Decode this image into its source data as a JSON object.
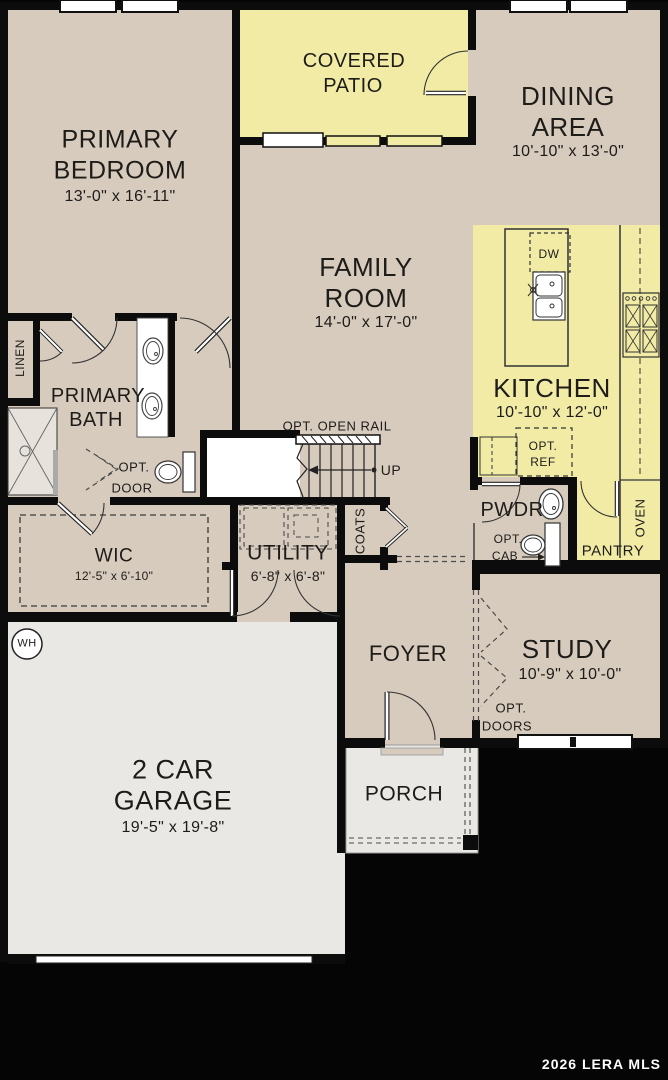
{
  "watermark": "2026 LERA MLS",
  "colors": {
    "floor_tan": "#d7cbbd",
    "floor_yellow": "#f1eba6",
    "floor_gray": "#e9e8e4",
    "wall": "#0c0c0c",
    "fixture_white": "#ffffff",
    "text": "#1e1c19"
  },
  "rooms": {
    "primary_bedroom": {
      "line1": "PRIMARY",
      "line2": "BEDROOM",
      "dims": "13'-0\" x 16'-11\""
    },
    "covered_patio": {
      "line1": "COVERED",
      "line2": "PATIO"
    },
    "dining_area": {
      "line1": "DINING",
      "line2": "AREA",
      "dims": "10'-10\" x 13'-0\""
    },
    "family_room": {
      "line1": "FAMILY",
      "line2": "ROOM",
      "dims": "14'-0\" x 17'-0\""
    },
    "kitchen": {
      "name": "KITCHEN",
      "dims": "10'-10\" x 12'-0\""
    },
    "primary_bath": {
      "line1": "PRIMARY",
      "line2": "BATH"
    },
    "linen": {
      "name": "LINEN"
    },
    "wic": {
      "name": "WIC",
      "dims": "12'-5\" x 6'-10\""
    },
    "utility": {
      "name": "UTILITY",
      "dims": "6'-8\" x 6'-8\""
    },
    "coats": {
      "name": "COATS"
    },
    "pwdr": {
      "name": "PWDR"
    },
    "pantry": {
      "name": "PANTRY"
    },
    "oven": {
      "name": "OVEN"
    },
    "foyer": {
      "name": "FOYER"
    },
    "study": {
      "name": "STUDY",
      "dims": "10'-9\" x 10'-0\""
    },
    "garage": {
      "line1": "2 CAR",
      "line2": "GARAGE",
      "dims": "19'-5\" x 19'-8\""
    },
    "porch": {
      "name": "PORCH"
    }
  },
  "labels": {
    "water_heater": "WH",
    "dishwasher": "DW",
    "up": "UP",
    "opt_open_rail": "OPT. OPEN RAIL",
    "opt_door_1": "OPT.",
    "opt_door_2": "DOOR",
    "opt_ref_1": "OPT.",
    "opt_ref_2": "REF",
    "opt_cab_1": "OPT.",
    "opt_cab_2": "CAB",
    "opt_doors_1": "OPT.",
    "opt_doors_2": "DOORS"
  }
}
